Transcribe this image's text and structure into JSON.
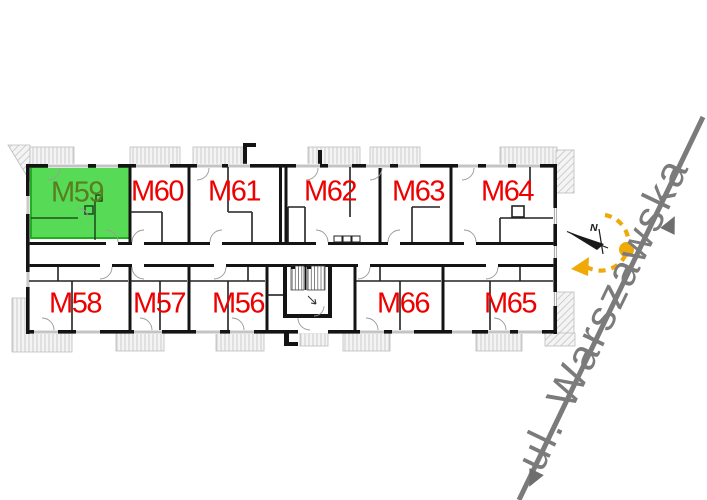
{
  "floorplan": {
    "apartments": [
      {
        "label": "M59",
        "row": "top",
        "selected": true
      },
      {
        "label": "M60",
        "row": "top",
        "selected": false
      },
      {
        "label": "M61",
        "row": "top",
        "selected": false
      },
      {
        "label": "M62",
        "row": "top",
        "selected": false
      },
      {
        "label": "M63",
        "row": "top",
        "selected": false
      },
      {
        "label": "M64",
        "row": "top",
        "selected": false
      },
      {
        "label": "M58",
        "row": "bottom",
        "selected": false
      },
      {
        "label": "M57",
        "row": "bottom",
        "selected": false
      },
      {
        "label": "M56",
        "row": "bottom",
        "selected": false
      },
      {
        "label": "M66",
        "row": "bottom",
        "selected": false
      },
      {
        "label": "M65",
        "row": "bottom",
        "selected": false
      }
    ]
  },
  "street": {
    "label": "ul. Warszawska"
  },
  "compass": {
    "north_label": "N"
  },
  "colors": {
    "selected_fill": "#57DB57",
    "selected_border": "#21AF21",
    "selected_label": "#5A7D1E",
    "apartment_label": "#EE0000",
    "street_gray": "#7B7B7B",
    "compass_accent": "#EFA909",
    "walls": "#141414"
  }
}
